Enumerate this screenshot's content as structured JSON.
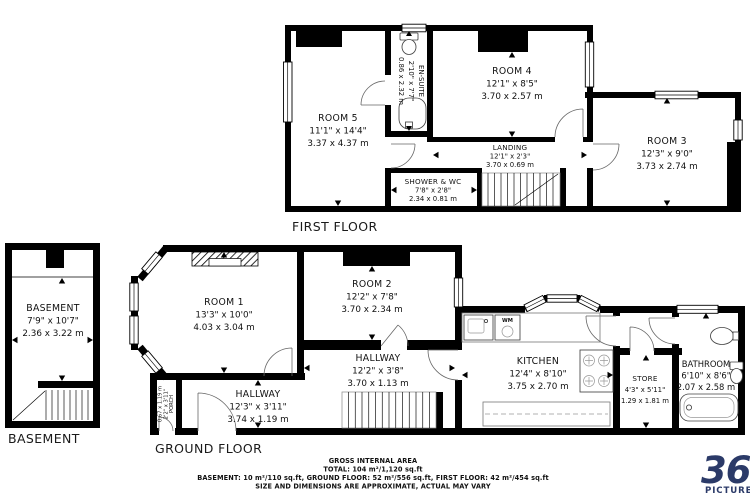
{
  "floors": {
    "first": {
      "label": "FIRST FLOOR",
      "rooms": {
        "room5": {
          "name": "ROOM 5",
          "imperial": "11'1\" x 14'4\"",
          "metric": "3.37 x 4.37 m"
        },
        "room4": {
          "name": "ROOM 4",
          "imperial": "12'1\" x 8'5\"",
          "metric": "3.70 x 2.57 m"
        },
        "room3": {
          "name": "ROOM 3",
          "imperial": "12'3\" x 9'0\"",
          "metric": "3.73 x 2.74 m"
        },
        "ensuite": {
          "name": "EN-SUITE",
          "imperial": "2'10\" x 7'7\"",
          "metric": "0.86 x 2.32 m"
        },
        "landing": {
          "name": "LANDING",
          "imperial": "12'1\" x 2'3\"",
          "metric": "3.70 x 0.69 m"
        },
        "shower_wc": {
          "name": "SHOWER & WC",
          "imperial": "7'8\" x 2'8\"",
          "metric": "2.34 x 0.81 m"
        }
      }
    },
    "ground": {
      "label": "GROUND FLOOR",
      "rooms": {
        "room1": {
          "name": "ROOM 1",
          "imperial": "13'3\" x 10'0\"",
          "metric": "4.03 x 3.04 m"
        },
        "room2": {
          "name": "ROOM 2",
          "imperial": "12'2\" x 7'8\"",
          "metric": "3.70 x 2.34 m"
        },
        "hallway_rear": {
          "name": "HALLWAY",
          "imperial": "12'2\" x 3'8\"",
          "metric": "3.70 x 1.13 m"
        },
        "hallway_front": {
          "name": "HALLWAY",
          "imperial": "12'3\" x 3'11\"",
          "metric": "3.74 x 1.19 m"
        },
        "porch": {
          "name": "PORCH",
          "imperial": "2'2\" x 3'11\"",
          "metric": "0.67 x 1.19 m"
        },
        "kitchen": {
          "name": "KITCHEN",
          "imperial": "12'4\" x 8'10\"",
          "metric": "3.75 x 2.70 m"
        },
        "store": {
          "name": "STORE",
          "imperial": "4'3\" x 5'11\"",
          "metric": "1.29 x 1.81 m"
        },
        "bathroom": {
          "name": "BATHROOM",
          "imperial": "6'10\" x 8'6\"",
          "metric": "2.07 x 2.58 m"
        }
      }
    },
    "basement": {
      "label": "BASEMENT",
      "rooms": {
        "basement": {
          "name": "BASEMENT",
          "imperial": "7'9\" x 10'7\"",
          "metric": "2.36 x 3.22 m"
        }
      }
    }
  },
  "fixtures": {
    "washing_machine": "WM"
  },
  "summary": {
    "title": "GROSS INTERNAL AREA",
    "total": "TOTAL: 104 m²/1,120 sq.ft",
    "breakdown": "BASEMENT: 10 m²/110 sq.ft, GROUND FLOOR: 52 m²/556 sq.ft, FIRST FLOOR: 42 m²/454 sq.ft",
    "disclaimer": "SIZE AND DIMENSIONS ARE APPROXIMATE, ACTUAL MAY VARY"
  },
  "logo": {
    "number": "360",
    "word": "PICTURE"
  },
  "colors": {
    "wall": "#000000",
    "logo_navy": "#2b3a68",
    "disclaimer_gray": "#b5b5b5"
  }
}
